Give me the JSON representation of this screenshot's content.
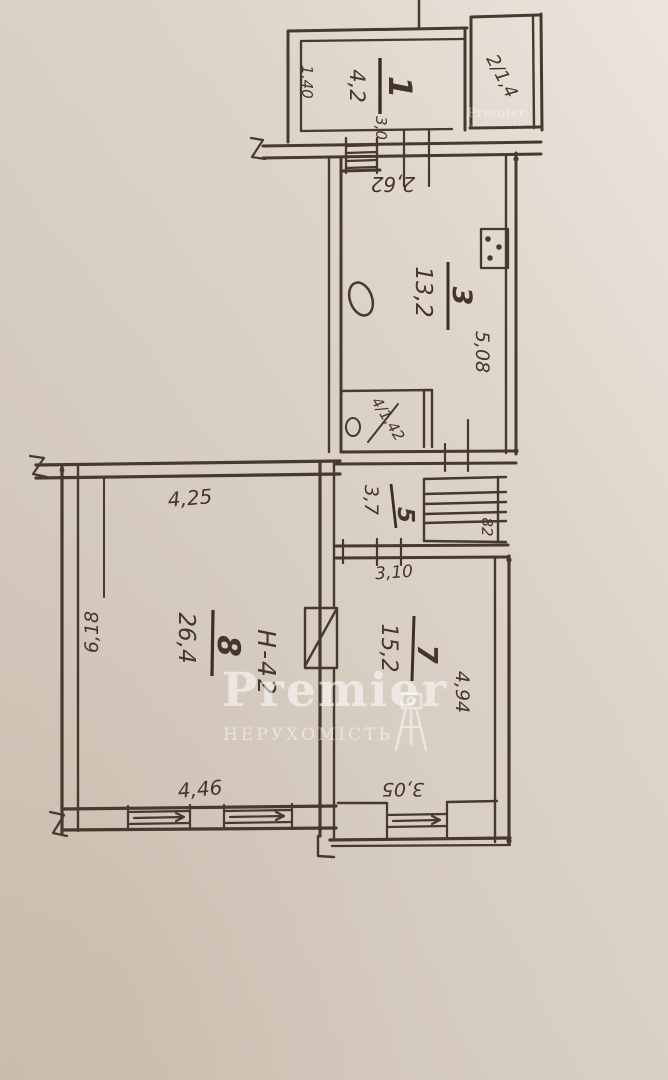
{
  "watermark": {
    "brand": "Premier",
    "subtitle": "НЕРУХОМІСТЬ"
  },
  "watermark_small": {
    "brand": "Premier",
    "subtitle": "НЕРУХОМІСТЬ"
  },
  "rooms": {
    "r1": {
      "area": "4,2",
      "number": "1"
    },
    "r2": {
      "label": "2/1,4"
    },
    "r3": {
      "area": "13,2",
      "number": "3"
    },
    "r4": {
      "label": "4/1,42"
    },
    "r5": {
      "area": "3,7",
      "number": "5"
    },
    "r7": {
      "area": "15,2",
      "number": "7"
    },
    "r8": {
      "area": "26,4",
      "number": "8"
    },
    "closet": {
      "label": "82"
    }
  },
  "dimensions": {
    "room1_depth": "1,40",
    "room1_width": "3,0",
    "kitchen_width": "2,62",
    "kitchen_length": "5,08",
    "hall_width": "3,10",
    "room8_width_top": "4,25",
    "room8_length": "6,18",
    "room8_width_bottom": "4,46",
    "room7_length": "4,94",
    "room7_width": "3,05"
  },
  "annotations": {
    "height_note": "Н-42"
  },
  "colors": {
    "ink": "#463a2e",
    "paper": "#dbd1c6",
    "watermark": "#ffffff"
  }
}
